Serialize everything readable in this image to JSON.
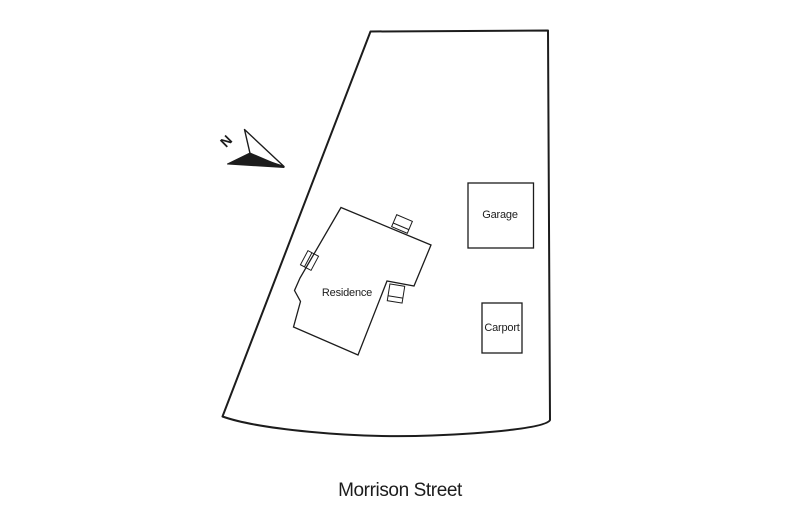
{
  "page": {
    "background": "#ffffff",
    "ink": "#1c1c1c"
  },
  "site_plan": {
    "street_label": "Morrison Street",
    "compass": {
      "label": "N",
      "icon": "north-arrow-icon"
    },
    "buildings": {
      "residence": {
        "label": "Residence"
      },
      "garage": {
        "label": "Garage"
      },
      "carport": {
        "label": "Carport"
      }
    }
  }
}
